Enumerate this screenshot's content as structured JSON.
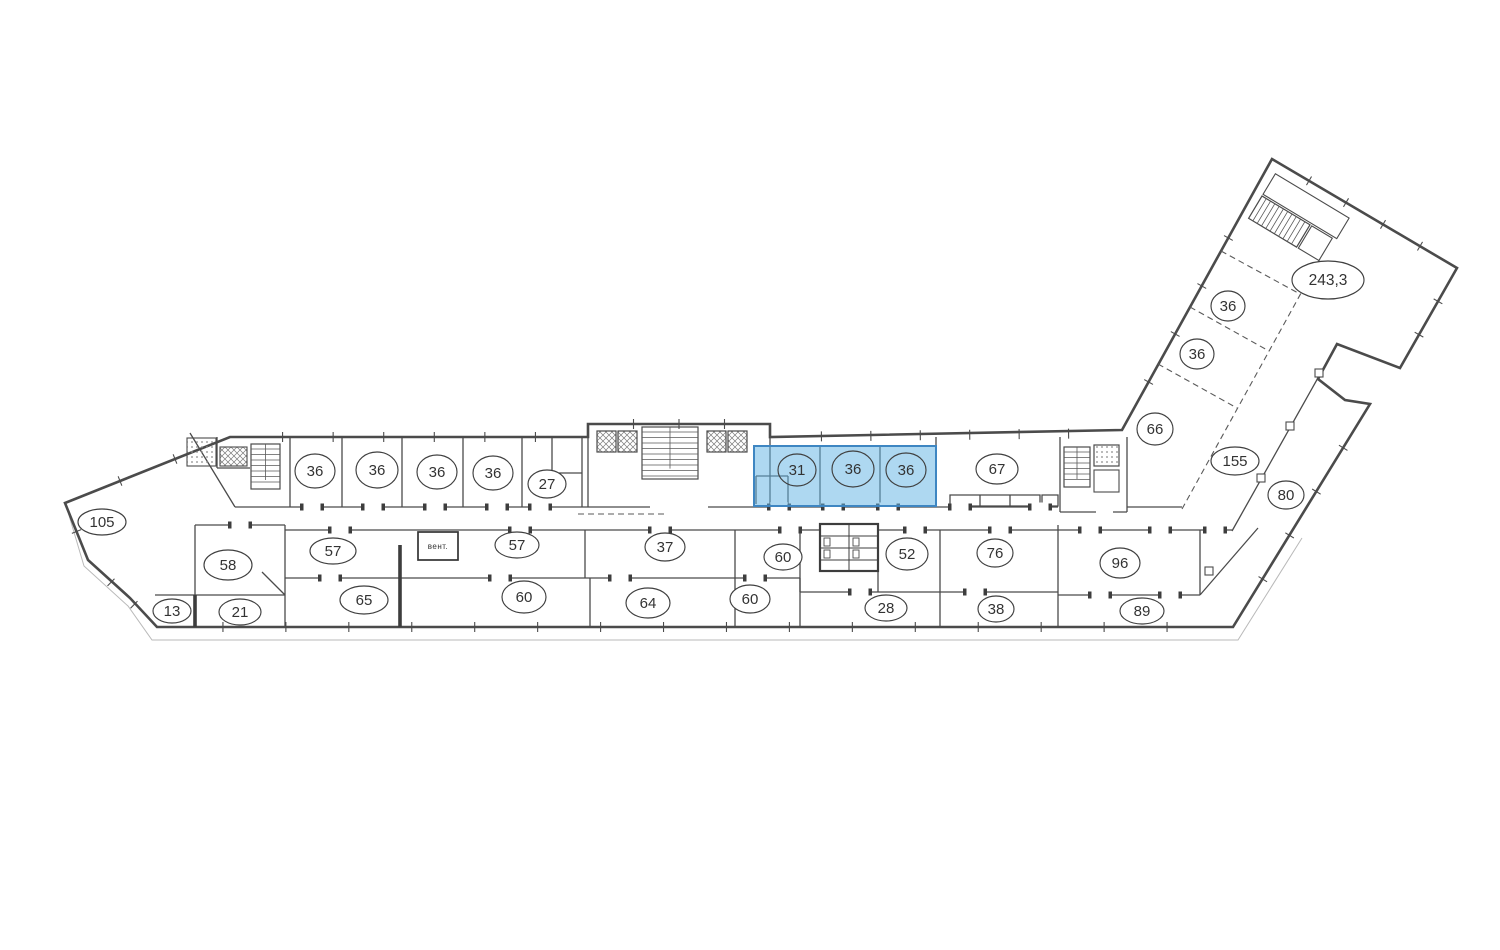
{
  "plan": {
    "type": "building-floor-plan",
    "language": "ru",
    "vent_box_label": "вент.",
    "colors": {
      "wall": "#4b4b4b",
      "thick_wall": "#3d3d3d",
      "paper": "#ffffff",
      "label_ink": "#333333",
      "highlight_fill": "#5eb2e4",
      "highlight_stroke": "#3e86c2"
    },
    "highlight": {
      "fill": "#5eb2e4",
      "fill_opacity": 0.5,
      "stroke": "#3e86c2",
      "room_labels": [
        "31",
        "36",
        "36"
      ]
    },
    "rooms": [
      {
        "label": "105",
        "cx": 102,
        "cy": 522,
        "rx": 24,
        "ry": 13
      },
      {
        "label": "58",
        "cx": 228,
        "cy": 565,
        "rx": 24,
        "ry": 15
      },
      {
        "label": "13",
        "cx": 172,
        "cy": 611,
        "rx": 19,
        "ry": 12
      },
      {
        "label": "21",
        "cx": 240,
        "cy": 612,
        "rx": 21,
        "ry": 13
      },
      {
        "label": "36",
        "cx": 315,
        "cy": 471,
        "rx": 20,
        "ry": 17
      },
      {
        "label": "36",
        "cx": 377,
        "cy": 470,
        "rx": 21,
        "ry": 18
      },
      {
        "label": "36",
        "cx": 437,
        "cy": 472,
        "rx": 20,
        "ry": 17
      },
      {
        "label": "36",
        "cx": 493,
        "cy": 473,
        "rx": 20,
        "ry": 17
      },
      {
        "label": "27",
        "cx": 547,
        "cy": 484,
        "rx": 19,
        "ry": 14
      },
      {
        "label": "57",
        "cx": 333,
        "cy": 551,
        "rx": 23,
        "ry": 13
      },
      {
        "label": "57",
        "cx": 517,
        "cy": 545,
        "rx": 22,
        "ry": 13
      },
      {
        "label": "65",
        "cx": 364,
        "cy": 600,
        "rx": 24,
        "ry": 14
      },
      {
        "label": "60",
        "cx": 524,
        "cy": 597,
        "rx": 22,
        "ry": 16
      },
      {
        "label": "37",
        "cx": 665,
        "cy": 547,
        "rx": 20,
        "ry": 14
      },
      {
        "label": "64",
        "cx": 648,
        "cy": 603,
        "rx": 22,
        "ry": 15
      },
      {
        "label": "60",
        "cx": 783,
        "cy": 557,
        "rx": 19,
        "ry": 13
      },
      {
        "label": "60",
        "cx": 750,
        "cy": 599,
        "rx": 20,
        "ry": 14
      },
      {
        "label": "31",
        "cx": 797,
        "cy": 470,
        "rx": 19,
        "ry": 16,
        "highlighted": true
      },
      {
        "label": "36",
        "cx": 853,
        "cy": 469,
        "rx": 21,
        "ry": 18,
        "highlighted": true
      },
      {
        "label": "36",
        "cx": 906,
        "cy": 470,
        "rx": 20,
        "ry": 17,
        "highlighted": true
      },
      {
        "label": "67",
        "cx": 997,
        "cy": 469,
        "rx": 21,
        "ry": 15
      },
      {
        "label": "52",
        "cx": 907,
        "cy": 554,
        "rx": 21,
        "ry": 16
      },
      {
        "label": "28",
        "cx": 886,
        "cy": 608,
        "rx": 21,
        "ry": 13
      },
      {
        "label": "76",
        "cx": 995,
        "cy": 553,
        "rx": 18,
        "ry": 14
      },
      {
        "label": "38",
        "cx": 996,
        "cy": 609,
        "rx": 18,
        "ry": 13
      },
      {
        "label": "96",
        "cx": 1120,
        "cy": 563,
        "rx": 20,
        "ry": 15
      },
      {
        "label": "89",
        "cx": 1142,
        "cy": 611,
        "rx": 22,
        "ry": 13
      },
      {
        "label": "66",
        "cx": 1155,
        "cy": 429,
        "rx": 18,
        "ry": 16
      },
      {
        "label": "36",
        "cx": 1197,
        "cy": 354,
        "rx": 17,
        "ry": 15
      },
      {
        "label": "36",
        "cx": 1228,
        "cy": 306,
        "rx": 17,
        "ry": 15
      },
      {
        "label": "155",
        "cx": 1235,
        "cy": 461,
        "rx": 24,
        "ry": 14
      },
      {
        "label": "80",
        "cx": 1286,
        "cy": 495,
        "rx": 18,
        "ry": 14
      },
      {
        "label": "243,3",
        "cx": 1328,
        "cy": 280,
        "rx": 36,
        "ry": 19
      }
    ]
  }
}
